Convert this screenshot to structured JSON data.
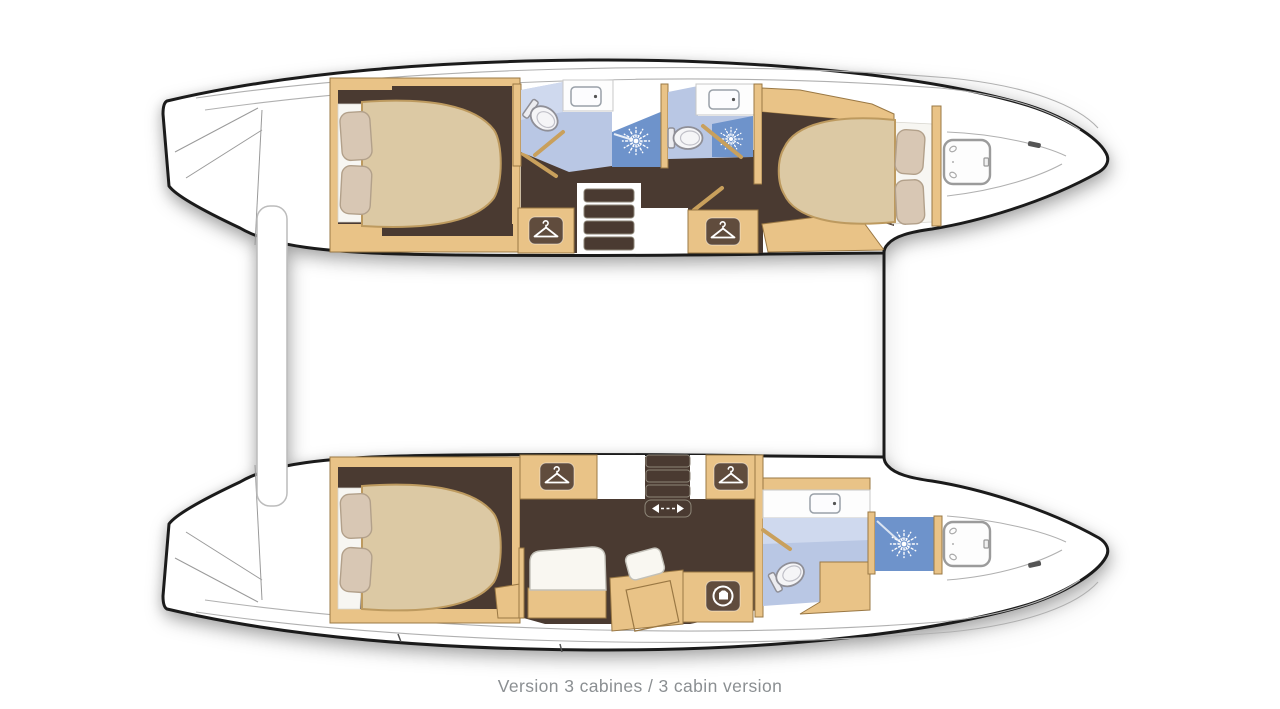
{
  "caption": {
    "text": "Version 3 cabines / 3 cabin version"
  },
  "colors": {
    "background": "#ffffff",
    "hull": "#ffffff",
    "outline": "#1b1b1b",
    "deck_line": "#b0b0b0",
    "wood": "#e9c387",
    "wood_edge": "#9a7844",
    "floor": "#4a3a31",
    "floor_edge": "#8d8678",
    "mattress": "#dcc9a4",
    "mattress_edge": "#bd9a5f",
    "pillow": "#d8c7b4",
    "pillow_edge": "#b2a08a",
    "bedding": "#f7f6f2",
    "bath": "#b9c7e4",
    "bath_light": "#cfd9ee",
    "shower": "#6e93cb",
    "icon_bg": "#604c3d",
    "icon_fg": "#ffffff",
    "door": "#c9a05c",
    "beam_edge": "#bcbcbc",
    "caption": "#8b8f92"
  },
  "icons": {
    "wardrobe": "clothes-hanger",
    "shower": "sunburst-spray",
    "laundry": "washing-machine-drum",
    "sliding_door": "left-right-double-arrow",
    "toilet": "toilet-top-view",
    "sink": "basin-with-faucet-dot",
    "deck_hatch": "rounded-square-hatch"
  },
  "features": {
    "cabin_count": 3,
    "double_beds": 3,
    "bathrooms": 3,
    "showers": 3,
    "wardrobes": 4,
    "washing_machine": 1,
    "companionway_stairs": 2,
    "deck_hatches": 2
  }
}
